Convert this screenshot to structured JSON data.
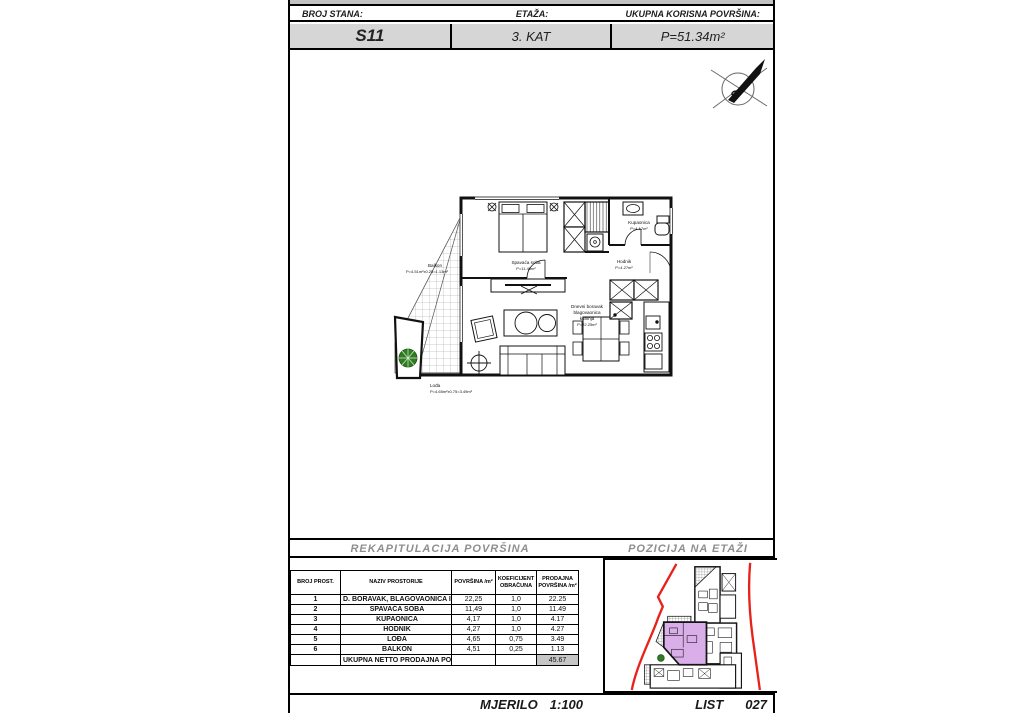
{
  "header": {
    "labels": [
      "BROJ STANA:",
      "ETAŽA:",
      "UKUPNA KORISNA POVRŠINA:"
    ],
    "values": [
      "S11",
      "3. KAT",
      "P=51.34m²"
    ]
  },
  "compass": {
    "letter": "S"
  },
  "plan": {
    "rooms": {
      "balkon": {
        "name": "Balkon",
        "calc": "P=4.51m²x0.25=1.13m²"
      },
      "spavaca": {
        "name": "Spavaća soba",
        "area": "P=11.49m²"
      },
      "kupaonica": {
        "name": "Kupaonica",
        "area": "P=4.17m²"
      },
      "hodnik": {
        "name": "Hodnik",
        "area": "P=4.27m²"
      },
      "dnevni": {
        "line1": "Dnevni boravak",
        "line2": "blagovaonica",
        "line3": "kuhinja",
        "area": "P=22.25m²"
      },
      "lodja": {
        "name": "Lođa",
        "calc": "P=4.65m²x0.75=3.49m²"
      }
    }
  },
  "sections": {
    "left_title": "REKAPITULACIJA POVRŠINA",
    "right_title": "POZICIJA NA ETAŽI"
  },
  "table": {
    "headers": [
      "BROJ PROST.",
      "NAZIV PROSTORIJE",
      "POVRŠINA /m²",
      "KOEFICIJENT OBRAČUNA",
      "PRODAJNA POVRŠINA /m²"
    ],
    "rows": [
      [
        "1",
        "D. BORAVAK, BLAGOVAONICA I KUHINJA",
        "22,25",
        "1,0",
        "22.25"
      ],
      [
        "2",
        "SPAVAĆA SOBA",
        "11,49",
        "1,0",
        "11.49"
      ],
      [
        "3",
        "KUPAONICA",
        "4,17",
        "1,0",
        "4.17"
      ],
      [
        "4",
        "HODNIK",
        "4,27",
        "1,0",
        "4.27"
      ],
      [
        "5",
        "LOĐA",
        "4,65",
        "0,75",
        "3.49"
      ],
      [
        "6",
        "BALKON",
        "4,51",
        "0,25",
        "1.13"
      ]
    ],
    "footer": {
      "label": "UKUPNA NETTO PRODAJNA POVRŠINA",
      "total": "45.67"
    }
  },
  "footer": {
    "mjerilo_label": "MJERILO",
    "mjerilo_value": "1:100",
    "list_label": "LIST",
    "list_value": "027"
  },
  "colors": {
    "site_line_red": "#e8221a",
    "unit_highlight": "#d9aee9",
    "value_row_gray": "#d6d6d6",
    "total_cell_gray": "#c6c6c6",
    "plant_green": "#2f7d22"
  }
}
